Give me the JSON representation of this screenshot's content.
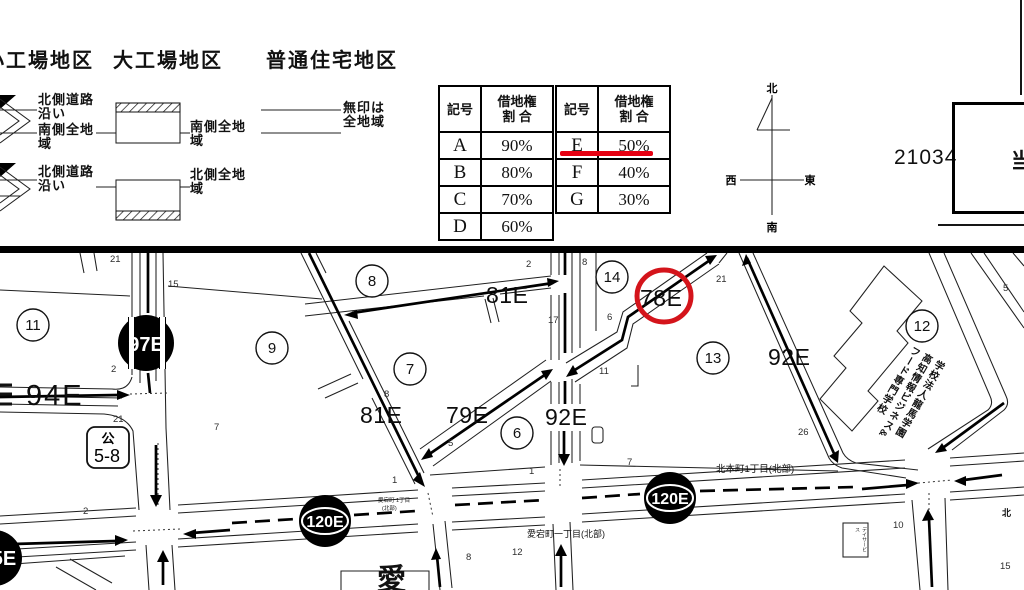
{
  "header": {
    "districts": {
      "small_factory": "小工場地区",
      "large_factory": "大工場地区",
      "residential": "普通住宅地区"
    },
    "legend_labels": {
      "sf_row1": "北側道路\n沿い",
      "sf_row1b": "南側全地\n域",
      "sf_row2": "北側道路\n沿い",
      "lf_row1": "南側全地\n域",
      "lf_row2": "北側全地\n域",
      "res": "無印は\n全地域"
    },
    "sheet_number": "21034",
    "corner_char": "当"
  },
  "tables": {
    "left": {
      "col1": "記号",
      "col2": "借地権\n割 合",
      "rows": [
        [
          "A",
          "90%"
        ],
        [
          "B",
          "80%"
        ],
        [
          "C",
          "70%"
        ],
        [
          "D",
          "60%"
        ]
      ]
    },
    "right": {
      "col1": "記号",
      "col2": "借地権\n割 合",
      "rows": [
        [
          "E",
          "50%"
        ],
        [
          "F",
          "40%"
        ],
        [
          "G",
          "30%"
        ]
      ],
      "highlighted_row": "E 50%"
    }
  },
  "compass": {
    "n": "北",
    "s": "南",
    "e": "東",
    "w": "西"
  },
  "map": {
    "values": {
      "v97": "97E",
      "v94": "94E",
      "v81a": "81E",
      "v81b": "81E",
      "v79": "79E",
      "v92v": "92E",
      "v92d": "92E",
      "v78": "78E",
      "v120a": "120E",
      "v120b": "120E",
      "v5e": "5E"
    },
    "blocks": [
      "11",
      "9",
      "8",
      "7",
      "6",
      "14",
      "13",
      "12"
    ],
    "parcels": [
      "21",
      "15",
      "2",
      "21",
      "2",
      "7",
      "2",
      "8",
      "17",
      "8",
      "5",
      "21",
      "6",
      "11",
      "26",
      "7",
      "1",
      "8",
      "12",
      "1",
      "10",
      "15",
      "5"
    ],
    "streets": {
      "atago_n_l1": "愛宕町 1丁目",
      "atago_n_l2": "(北部)",
      "atago_s": "愛宕町一丁目(北部)",
      "kitahon": "北本町1丁目(北部)",
      "kita_partial": "北"
    },
    "park_box": {
      "l1": "公",
      "l2": "5-8"
    },
    "school_text": [
      "学校法人龍馬学園",
      "高知情報ビジネス&",
      "フード専門学校"
    ],
    "dayservice": "デイサービス",
    "big_char": "愛"
  },
  "colors": {
    "highlight_red": "#e60012",
    "circle_red": "#d4141b"
  }
}
